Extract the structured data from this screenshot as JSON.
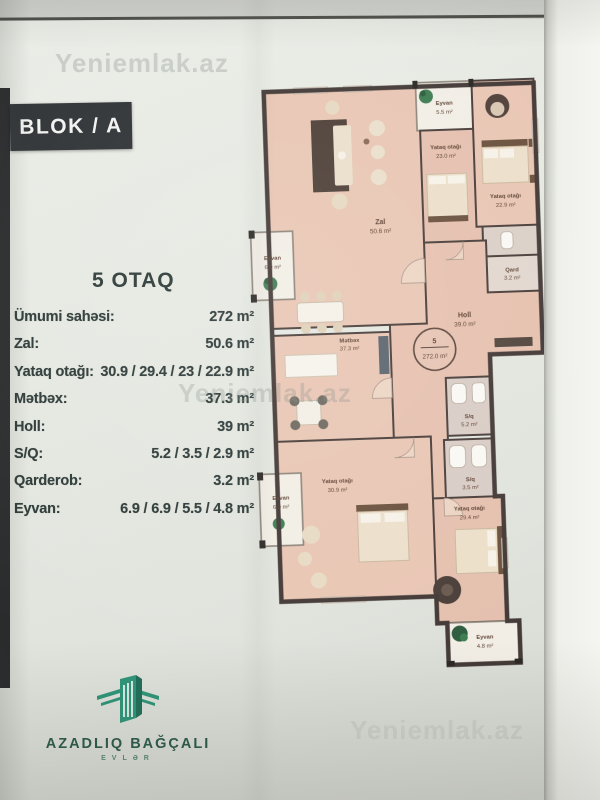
{
  "page": {
    "block_label": "BLOK / A",
    "apartment_title": "5 OTAQ",
    "watermark": "Yeniemlak.az"
  },
  "specs": {
    "rows": [
      {
        "label": "Ümumi sahəsi:",
        "value": "272 m²"
      },
      {
        "label": "Zal:",
        "value": "50.6 m²"
      },
      {
        "label": "Yataq otağı:",
        "value": "30.9 / 29.4 / 23 / 22.9 m²"
      },
      {
        "label": "Mətbəx:",
        "value": "37.3 m²"
      },
      {
        "label": "Holl:",
        "value": "39 m²"
      },
      {
        "label": "S/Q:",
        "value": "5.2 / 3.5 / 2.9 m²"
      },
      {
        "label": "Qarderob:",
        "value": "3.2 m²"
      },
      {
        "label": "Eyvan:",
        "value": "6.9 / 6.9 / 5.5 / 4.8 m²"
      }
    ]
  },
  "plan": {
    "badge": {
      "number": "5",
      "area": "272.0 m²"
    },
    "rooms": [
      {
        "name": "Zal",
        "area": "50.6 m²"
      },
      {
        "name": "Eyvan",
        "area": "5.5 m²"
      },
      {
        "name": "Yataq otağı",
        "area": "23.0 m²"
      },
      {
        "name": "Yataq otağı",
        "area": "22.9 m²"
      },
      {
        "name": "Qard",
        "area": "3.2 m²"
      },
      {
        "name": "Eyvan",
        "area": "6.9 m²"
      },
      {
        "name": "Mətbəx",
        "area": "37.3 m²"
      },
      {
        "name": "Holl",
        "area": "39.0 m²"
      },
      {
        "name": "S/q",
        "area": "5.2 m²"
      },
      {
        "name": "S/q",
        "area": "3.5 m²"
      },
      {
        "name": "Yataq otağı",
        "area": "30.9 m²"
      },
      {
        "name": "Yataq otağı",
        "area": "29.4 m²"
      },
      {
        "name": "Eyvan",
        "area": "6.9 m²"
      },
      {
        "name": "Eyvan",
        "area": "4.8 m²"
      }
    ]
  },
  "footer": {
    "brand": "AZADLIQ BAĞÇALI",
    "sub": "EVLƏR"
  },
  "colors": {
    "wall": "#443a37",
    "floor": "#e9c6b4",
    "balcony": "#f2eee6",
    "brand_green": "#2e9578",
    "text_dark": "#2d3a38"
  }
}
